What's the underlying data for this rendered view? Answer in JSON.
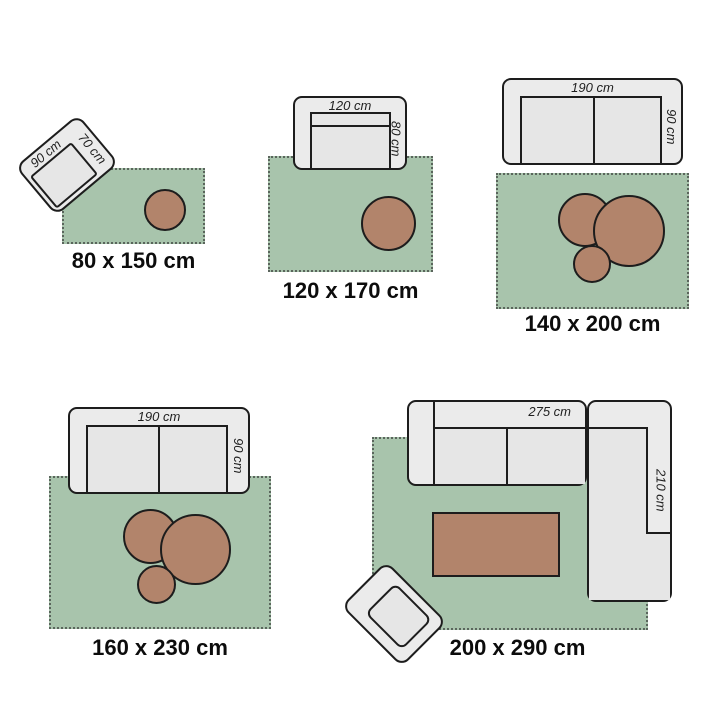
{
  "title": "rug-size-guide",
  "colors": {
    "background": "#ffffff",
    "rug_fill": "#a8c4ac",
    "rug_stitch": "#5a655c",
    "pouf_fill": "#b2846b",
    "table_fill": "#b2846b",
    "furniture_fill": "#ebebeb",
    "furniture_seat_fill": "#e6e6e6",
    "outline": "#1d1d1d",
    "dimension_text_color": "#1f1f1f",
    "label_text_color": "#0c0c0c"
  },
  "illustrations": [
    {
      "size_label": "80 x 150 cm",
      "furniture": "armchair-angled",
      "dims": {
        "width": "90 cm",
        "depth": "70 cm"
      }
    },
    {
      "size_label": "120 x 170 cm",
      "furniture": "loveseat",
      "dims": {
        "width": "120 cm",
        "depth": "80 cm"
      }
    },
    {
      "size_label": "140 x 200 cm",
      "furniture": "two-seat-sofa",
      "dims": {
        "width": "190 cm",
        "depth": "90 cm"
      }
    },
    {
      "size_label": "160 x 230 cm",
      "furniture": "two-seat-sofa",
      "dims": {
        "width": "190 cm",
        "depth": "90 cm"
      }
    },
    {
      "size_label": "200 x 290 cm",
      "furniture": "corner-sofa",
      "dims": {
        "width": "275 cm",
        "depth": "210 cm"
      }
    }
  ]
}
